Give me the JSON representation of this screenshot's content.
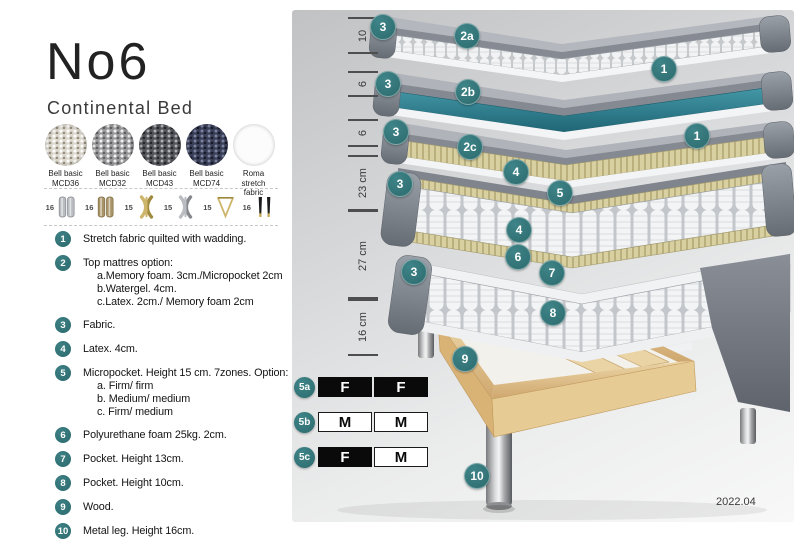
{
  "header": {
    "title": "No6",
    "subtitle": "Continental Bed"
  },
  "swatches": [
    {
      "line1": "Bell basic",
      "line2": "MCD36"
    },
    {
      "line1": "Bell basic",
      "line2": "MCD32"
    },
    {
      "line1": "Bell basic",
      "line2": "MCD43"
    },
    {
      "line1": "Bell basic",
      "line2": "MCD74"
    },
    {
      "line1": "Roma",
      "line2": "stretch fabric"
    }
  ],
  "legs": [
    {
      "height": "16",
      "shape": "cyl",
      "tone": "silver"
    },
    {
      "height": "16",
      "shape": "cyl",
      "tone": "bronze"
    },
    {
      "height": "15",
      "shape": "cross",
      "tone": "gold"
    },
    {
      "height": "15",
      "shape": "cross",
      "tone": "silver"
    },
    {
      "height": "15",
      "shape": "hairpin",
      "tone": "gold"
    },
    {
      "height": "16",
      "shape": "taper",
      "tone": "black"
    }
  ],
  "legend": [
    {
      "num": "1",
      "text": "Stretch fabric quilted with wadding."
    },
    {
      "num": "2",
      "text": "Top mattres option:",
      "subs": [
        "a.Memory foam. 3cm./Micropocket 2cm",
        "b.Watergel. 4cm.",
        "c.Latex. 2cm./ Memory foam 2cm"
      ]
    },
    {
      "num": "3",
      "text": "Fabric."
    },
    {
      "num": "4",
      "text": "Latex. 4cm."
    },
    {
      "num": "5",
      "text": "Micropocket. Height 15 cm. 7zones. Option:",
      "subs": [
        "a. Firm/ firm",
        "b. Medium/ medium",
        "c. Firm/ medium"
      ]
    },
    {
      "num": "6",
      "text": "Polyurethane foam 25kg. 2cm."
    },
    {
      "num": "7",
      "text": "Pocket. Height 13cm."
    },
    {
      "num": "8",
      "text": "Pocket. Height 10cm."
    },
    {
      "num": "9",
      "text": "Wood."
    },
    {
      "num": "10",
      "text": "Metal leg. Height 16cm."
    }
  ],
  "diagram": {
    "dimensions": [
      {
        "label": "10"
      },
      {
        "label": "6"
      },
      {
        "label": "6"
      },
      {
        "label": "23 cm"
      },
      {
        "label": "27 cm"
      },
      {
        "label": "16 cm"
      }
    ],
    "callouts": [
      {
        "label": "3"
      },
      {
        "label": "2a"
      },
      {
        "label": "1"
      },
      {
        "label": "3"
      },
      {
        "label": "2b"
      },
      {
        "label": "3"
      },
      {
        "label": "2c"
      },
      {
        "label": "1"
      },
      {
        "label": "3"
      },
      {
        "label": "4"
      },
      {
        "label": "5"
      },
      {
        "label": "4"
      },
      {
        "label": "3"
      },
      {
        "label": "6"
      },
      {
        "label": "7"
      },
      {
        "label": "8"
      },
      {
        "label": "9"
      },
      {
        "label": "10"
      }
    ],
    "firmness": [
      {
        "id": "5a",
        "cells": [
          {
            "label": "F",
            "variant": "dark"
          },
          {
            "label": "F",
            "variant": "dark"
          }
        ]
      },
      {
        "id": "5b",
        "cells": [
          {
            "label": "M",
            "variant": "light"
          },
          {
            "label": "M",
            "variant": "light"
          }
        ]
      },
      {
        "id": "5c",
        "cells": [
          {
            "label": "F",
            "variant": "dark"
          },
          {
            "label": "M",
            "variant": "light"
          }
        ]
      }
    ],
    "version": "2022.04"
  },
  "colors": {
    "accent_teal": "#2d6b6e",
    "watergel": "#2f7c8c",
    "latex": "#d8d0a0",
    "fabric_gray": "#7d828b",
    "wood": "#e4c893"
  }
}
